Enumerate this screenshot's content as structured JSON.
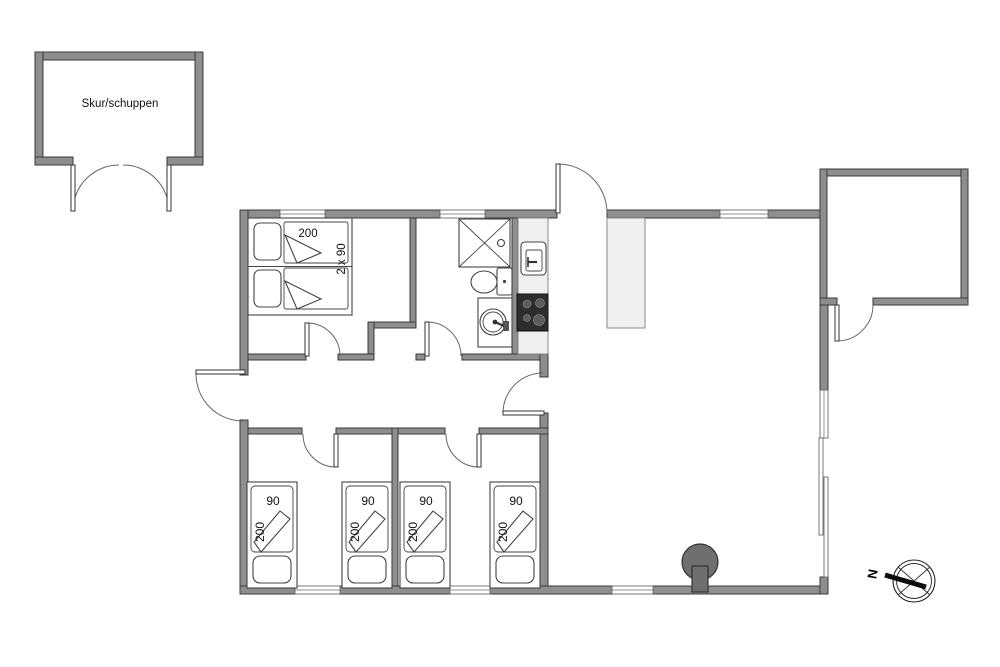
{
  "shed": {
    "label": "Skur/schuppen"
  },
  "double_bedroom": {
    "bed_length": "200",
    "bed_width": "2 x 90"
  },
  "single_beds": [
    {
      "width": "90",
      "length": "200"
    },
    {
      "width": "90",
      "length": "200"
    },
    {
      "width": "90",
      "length": "200"
    },
    {
      "width": "90",
      "length": "200"
    }
  ],
  "compass": {
    "north": "N"
  },
  "colors": {
    "wall": "#8e8e8e",
    "wall_outline": "#3a3a3a",
    "door_arc": "#666666",
    "stove_top": "#2d2d2d",
    "appliance": "#f0f0f0",
    "wood_stove": "#6f6f6f"
  }
}
